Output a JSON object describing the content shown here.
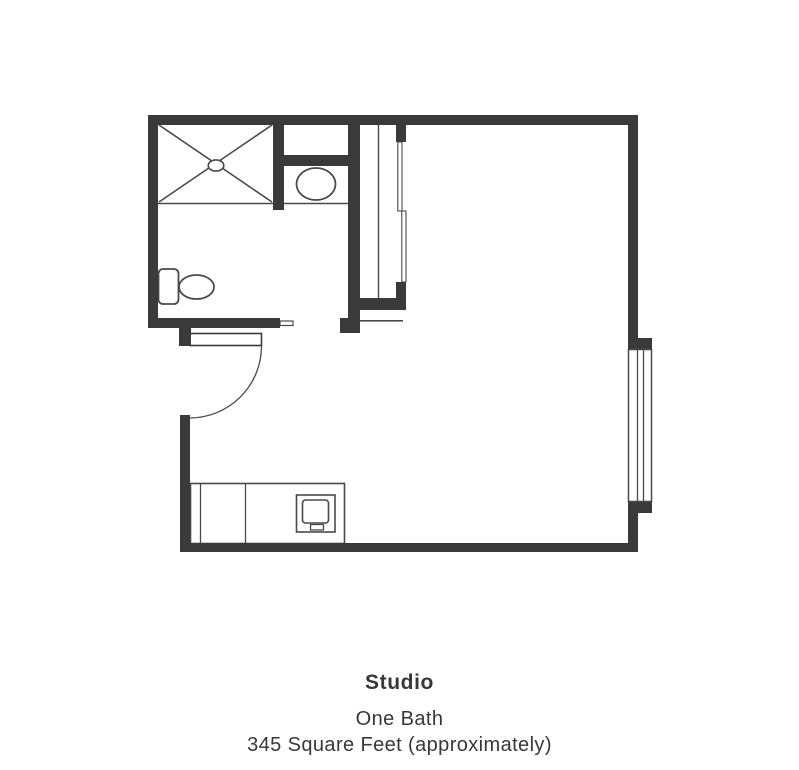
{
  "page": {
    "background_color": "#ffffff"
  },
  "floorplan": {
    "name": "studio-apartment-floor-plan",
    "wall_color": "#3a3a3a",
    "line_color": "#4a4a4a",
    "fixtures": [
      "shower",
      "bathroom-sink",
      "medicine-niche",
      "toilet",
      "entry-door-swing",
      "closet-sliding-doors",
      "window",
      "kitchen-counter",
      "cooktop"
    ]
  },
  "caption": {
    "title": "Studio",
    "line1": "One Bath",
    "line2": "345 Square Feet (approximately)",
    "text_color": "#383838"
  }
}
